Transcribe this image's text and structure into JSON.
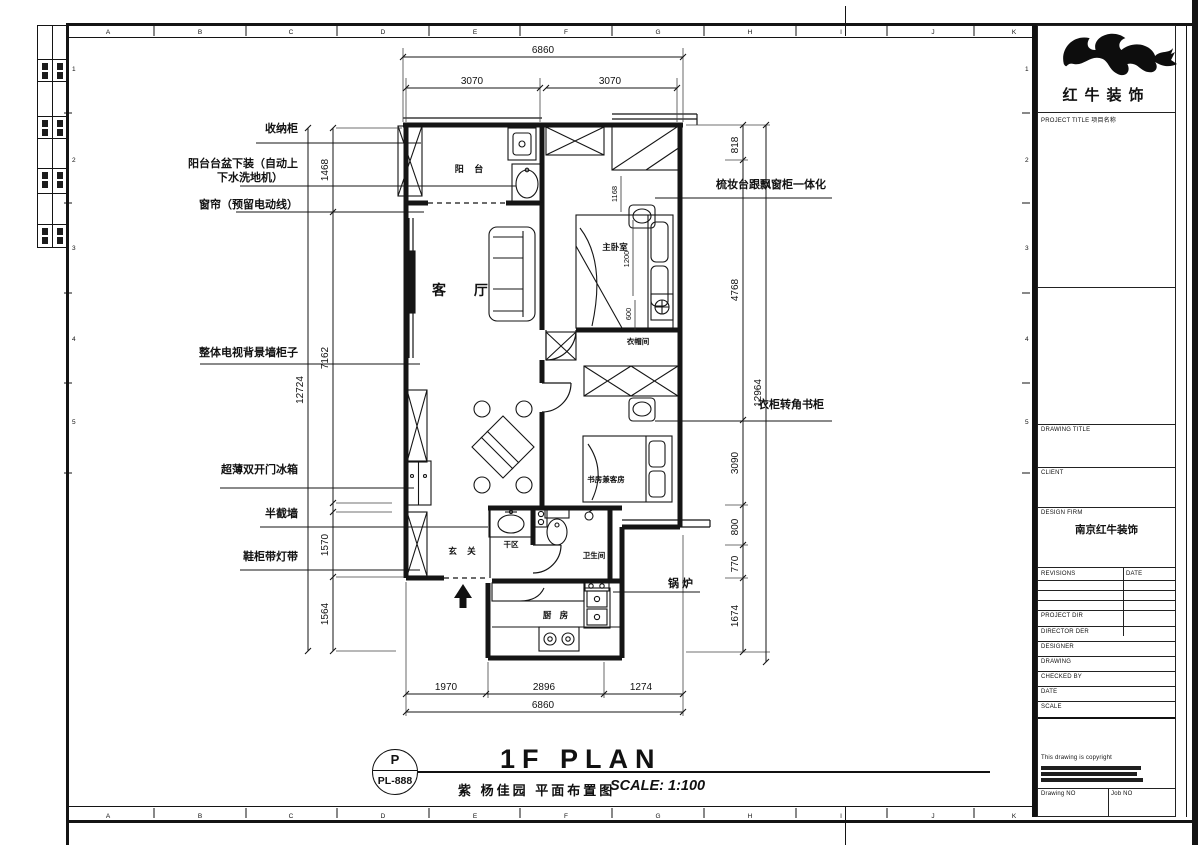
{
  "sheet": {
    "grid_letters": [
      "A",
      "B",
      "C",
      "D",
      "E",
      "F",
      "G",
      "H",
      "I",
      "J",
      "K"
    ],
    "grid_numbers": [
      "1",
      "2",
      "3",
      "4",
      "5"
    ]
  },
  "plan": {
    "rooms": {
      "balcony": "阳 台",
      "living": "客 厅",
      "master": "主卧室",
      "cloak": "衣帽间",
      "study": "书房兼客房",
      "dry": "干区",
      "foyer": "玄 关",
      "bath": "卫生间",
      "kitchen": "厨 房"
    },
    "left_labels": {
      "cabinet": "收纳柜",
      "basin1": "阳台台盆下装（自动上",
      "basin2": "下水洗地机）",
      "curtain": "窗帘（预留电动线）",
      "tvwall": "整体电视背景墙柜子",
      "fridge": "超薄双开门冰箱",
      "halfwall": "半截墙",
      "shoe": "鞋柜带灯带"
    },
    "right_labels": {
      "dresser": "梳妆台跟飘窗柜一体化",
      "wardrobe": "衣柜转角书柜",
      "boiler": "锅 炉"
    },
    "dims": {
      "top_total": "6860",
      "top_left": "3070",
      "top_right": "3070",
      "left_total": "12724",
      "l1": "1468",
      "l2": "7162",
      "l3": "1570",
      "l4": "1564",
      "right_total": "12964",
      "r1": "818",
      "r2": "4768",
      "r3": "3090",
      "r4": "800",
      "r5": "770",
      "r6": "1674",
      "bottom_total": "6860",
      "b1": "1970",
      "b2": "2896",
      "b3": "1274",
      "i1": "1168",
      "i2": "1200",
      "i3": "600"
    }
  },
  "titlebar": {
    "bubble_letter": "P",
    "bubble_code": "PL-888",
    "title": "1F PLAN",
    "subtitle": "紫 杨佳园 平面布置图",
    "scale": "SCALE: 1:100"
  },
  "titleblock": {
    "company": "红牛装饰",
    "project_title": "PROJECT TITLE  项目名称",
    "drawing_title": "DRAWING TITLE",
    "client": "CLIENT",
    "design_firm": "DESIGN FIRM",
    "design_firm_value": "南京红牛装饰",
    "revisions": "REVISIONS",
    "date_col": "DATE",
    "project_dir": "PROJECT DIR",
    "director": "DIRECTOR DER",
    "designer": "DESIGNER",
    "drawing": "DRAWING",
    "checked_by": "CHECKED BY",
    "date": "DATE",
    "scale": "SCALE",
    "copyright": "This drawing is copyright",
    "drawing_no": "Drawing NO",
    "job_no": "Job NO"
  }
}
